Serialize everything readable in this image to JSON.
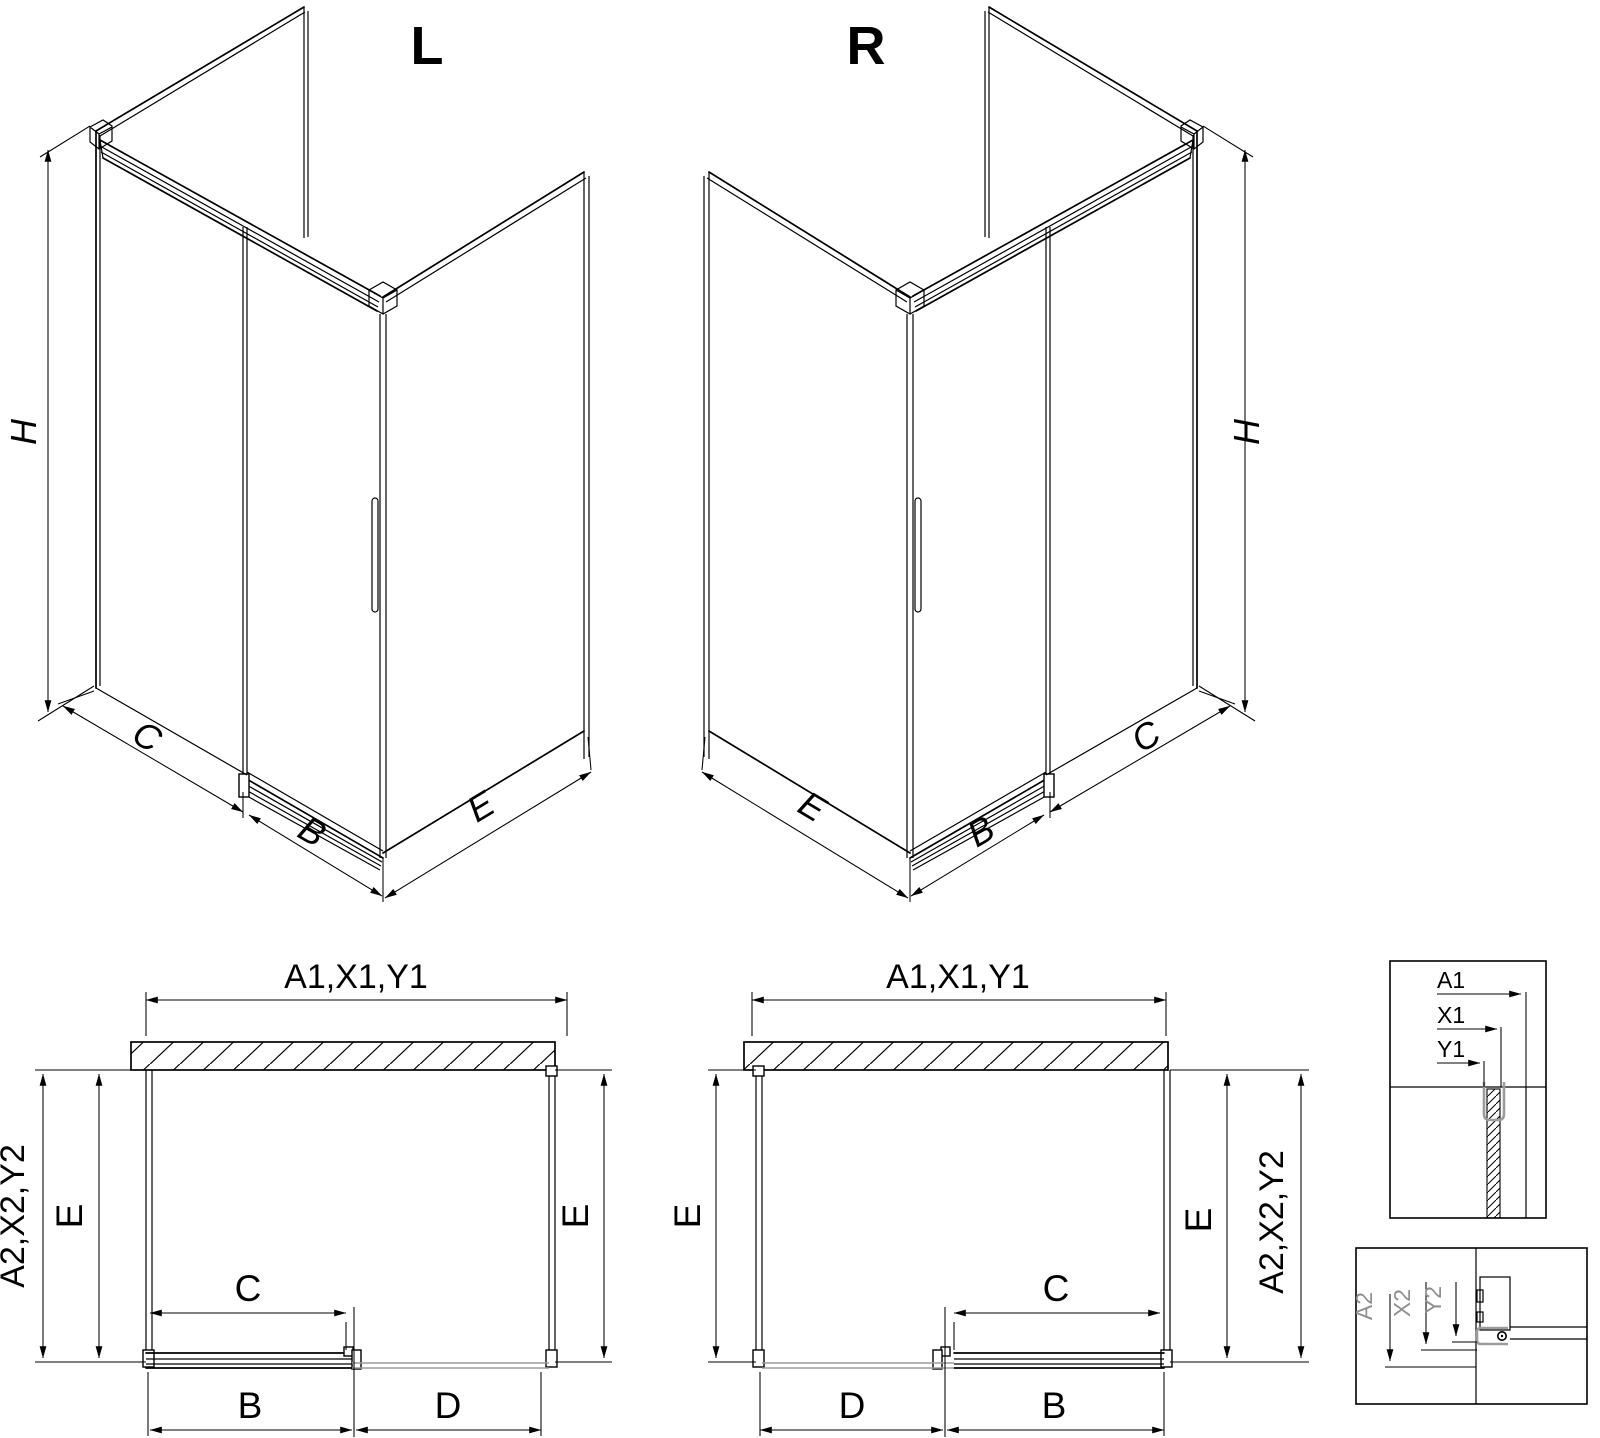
{
  "colors": {
    "line": "#000000",
    "profile_gray": "#9c9c9c",
    "background": "#ffffff"
  },
  "iso_left": {
    "title": "L",
    "height": "H",
    "fixed_width": "C",
    "door_width": "B",
    "side_depth": "E"
  },
  "iso_right": {
    "title": "R",
    "height": "H",
    "fixed_width": "C",
    "door_width": "B",
    "side_depth": "E"
  },
  "plan_left": {
    "total_width": "A1,X1,Y1",
    "total_depth": "A2,X2,Y2",
    "side_left": "E",
    "side_right": "E",
    "opening": "C",
    "door": "B",
    "fixed": "D"
  },
  "plan_right": {
    "total_width": "A1,X1,Y1",
    "total_depth": "A2,X2,Y2",
    "side_left": "E",
    "side_right": "E",
    "opening": "C",
    "door": "B",
    "fixed": "D"
  },
  "detail_wall_profile": {
    "a": "A1",
    "x": "X1",
    "y": "Y1"
  },
  "detail_bottom_track": {
    "a": "A2",
    "x": "X2",
    "y": "Y2"
  }
}
